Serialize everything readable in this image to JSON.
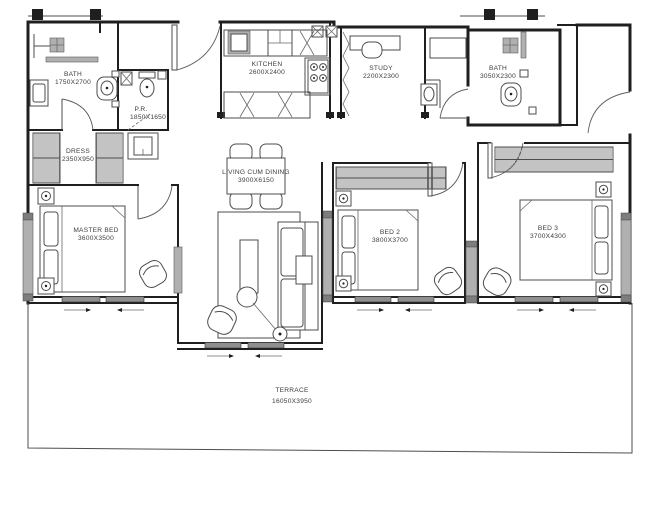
{
  "drawing": {
    "kind": "apartment floor plan",
    "view": "top-down architectural plan, black line work on white"
  },
  "rooms": {
    "bath_left": {
      "name": "BATH",
      "dims": "1750X2700"
    },
    "pr": {
      "name": "P.R.",
      "dims": "1850X1650"
    },
    "dress": {
      "name": "DRESS",
      "dims": "2350X950"
    },
    "kitchen": {
      "name": "KITCHEN",
      "dims": "2600X2400"
    },
    "study": {
      "name": "STUDY",
      "dims": "2200X2300"
    },
    "bath_right": {
      "name": "BATH",
      "dims": "3050X2300"
    },
    "master_bed": {
      "name": "MASTER BED",
      "dims": "3600X3500"
    },
    "living": {
      "name": "LIVING CUM DINING",
      "dims": "3900X6150"
    },
    "bed2": {
      "name": "BED 2",
      "dims": "3800X3700"
    },
    "bed3": {
      "name": "BED 3",
      "dims": "3700X4300"
    },
    "terrace": {
      "name": "TERRACE",
      "dims": "16050X3950"
    }
  },
  "colors": {
    "wall": "#1f1f1f",
    "furniture_line": "#4d4d4d",
    "window_gray": "#b0b0b0",
    "sliding_panel_gray": "#8f8f8f",
    "text": "#3c3c3c",
    "background": "#ffffff"
  }
}
